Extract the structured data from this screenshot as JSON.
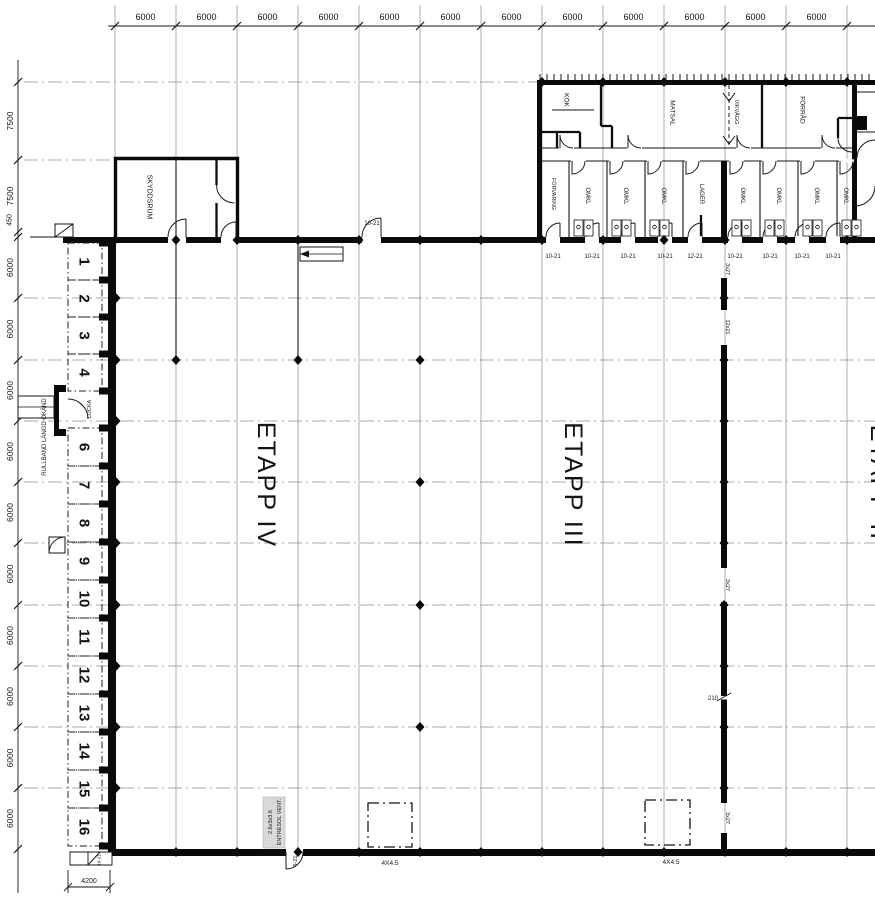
{
  "plan": {
    "top_dims": [
      "6000",
      "6000",
      "6000",
      "6000",
      "6000",
      "6000",
      "6000",
      "6000",
      "6000",
      "6000",
      "6000",
      "6000"
    ],
    "left_dims": [
      "7500",
      "7500",
      "450",
      "6000",
      "6000",
      "6000",
      "6000",
      "6000",
      "6000",
      "6000",
      "6000",
      "6000",
      "6000"
    ],
    "bottom_dims": {
      "left": "4200"
    },
    "bays": [
      "1",
      "2",
      "3",
      "4",
      "6",
      "7",
      "8",
      "9",
      "10",
      "11",
      "12",
      "13",
      "14",
      "15",
      "16"
    ],
    "rooms": {
      "upper": [
        "KÖK",
        "MATSAL",
        "VIKVÄGG",
        "FÖRRÅD"
      ],
      "lower": [
        "FÖRVARING",
        "OMKL",
        "OMKL",
        "OMKL",
        "LAGER",
        "OMKL",
        "OMKL",
        "OMKL",
        "OMKL"
      ],
      "shelter": "SKYDDSRUM"
    },
    "zones": [
      "ETAPP IV",
      "ETAPP III",
      "ETAPP II"
    ],
    "door_tags": [
      "10-21",
      "10-21",
      "10-21",
      "10-21",
      "12-21",
      "10-21",
      "10-21",
      "10-21",
      "10-21"
    ],
    "top_door_tag": "10-21",
    "bottom_door_tag": "9-21",
    "corner_door_tag": "10-21",
    "wall_tags": [
      "3x27",
      "12x21",
      "3x27",
      "210",
      "3x27"
    ],
    "vent_tags": [
      "4X4.5",
      "4X4.5"
    ],
    "notes": {
      "lucka": "LUCKA",
      "rullband": "RULLBAND LÄNGD OKÄND",
      "entresol_line1": "ENTRESOL VENT.",
      "entresol_line2": "2.6x3x3.6"
    },
    "colors": {
      "line": "#141414",
      "wall": "#0a0a0a",
      "grid": "#8a8a8a"
    }
  }
}
